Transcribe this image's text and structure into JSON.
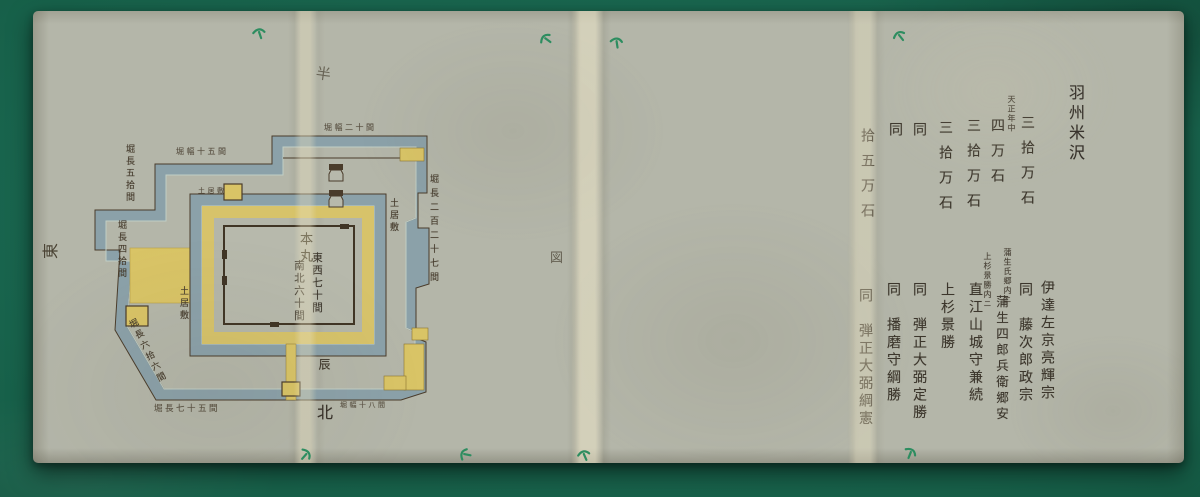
{
  "colors": {
    "felt_green": "#176049",
    "paper": "#b4b6a9",
    "moat_blue": "#8ba1a9",
    "wall_yellow": "#d9c466",
    "outline_brown": "#4a3c2b",
    "ink": "#3c362c",
    "thread_green": "#2d8d60",
    "fold_cream": "#e6dcc0"
  },
  "compass": {
    "east": "東",
    "north": "北",
    "se": "辰"
  },
  "marks": {
    "top_fold": "半",
    "center_fold": "図"
  },
  "map": {
    "honmaru": {
      "name": "本丸",
      "east_west": "東西七十間",
      "north_south": "南北六十間"
    },
    "labels": {
      "doishiki_right": "土居敷",
      "doishiki_left": "土居敷",
      "doishiki_top": "土居敷",
      "hori_right": "堀長二百二十七間",
      "hori_left_upper": "堀長五拾間",
      "hori_left": "堀長四拾間",
      "hori_sw": "堀長六拾六間",
      "hori_top_left": "堀幅十五間",
      "hori_top_right": "堀幅二十間",
      "hori_bottom_left": "堀長七十五間",
      "hori_bottom_right": "堀幅十八間"
    }
  },
  "roster": {
    "title": "羽州米沢",
    "entries": [
      {
        "name": "伊達左京亮輝宗"
      },
      {
        "amount": "三拾万石",
        "era_note": "天正年中",
        "name": "同　藤次郎政宗"
      },
      {
        "amount": "四万石",
        "note": "蒲生氏郷内ニ",
        "name": "蒲生四郎兵衛郷安"
      },
      {
        "amount": "三拾万石",
        "note": "上杉景勝内ニ",
        "name": "直江山城守兼続"
      },
      {
        "amount": "三拾万石",
        "name": "上杉景勝"
      },
      {
        "amount": "同",
        "name": "同　弾正大弼定勝"
      },
      {
        "amount": "同",
        "name": "同　播磨守綱勝"
      },
      {
        "amount": "拾五万石",
        "name": "同　弾正大弼綱憲"
      }
    ]
  }
}
